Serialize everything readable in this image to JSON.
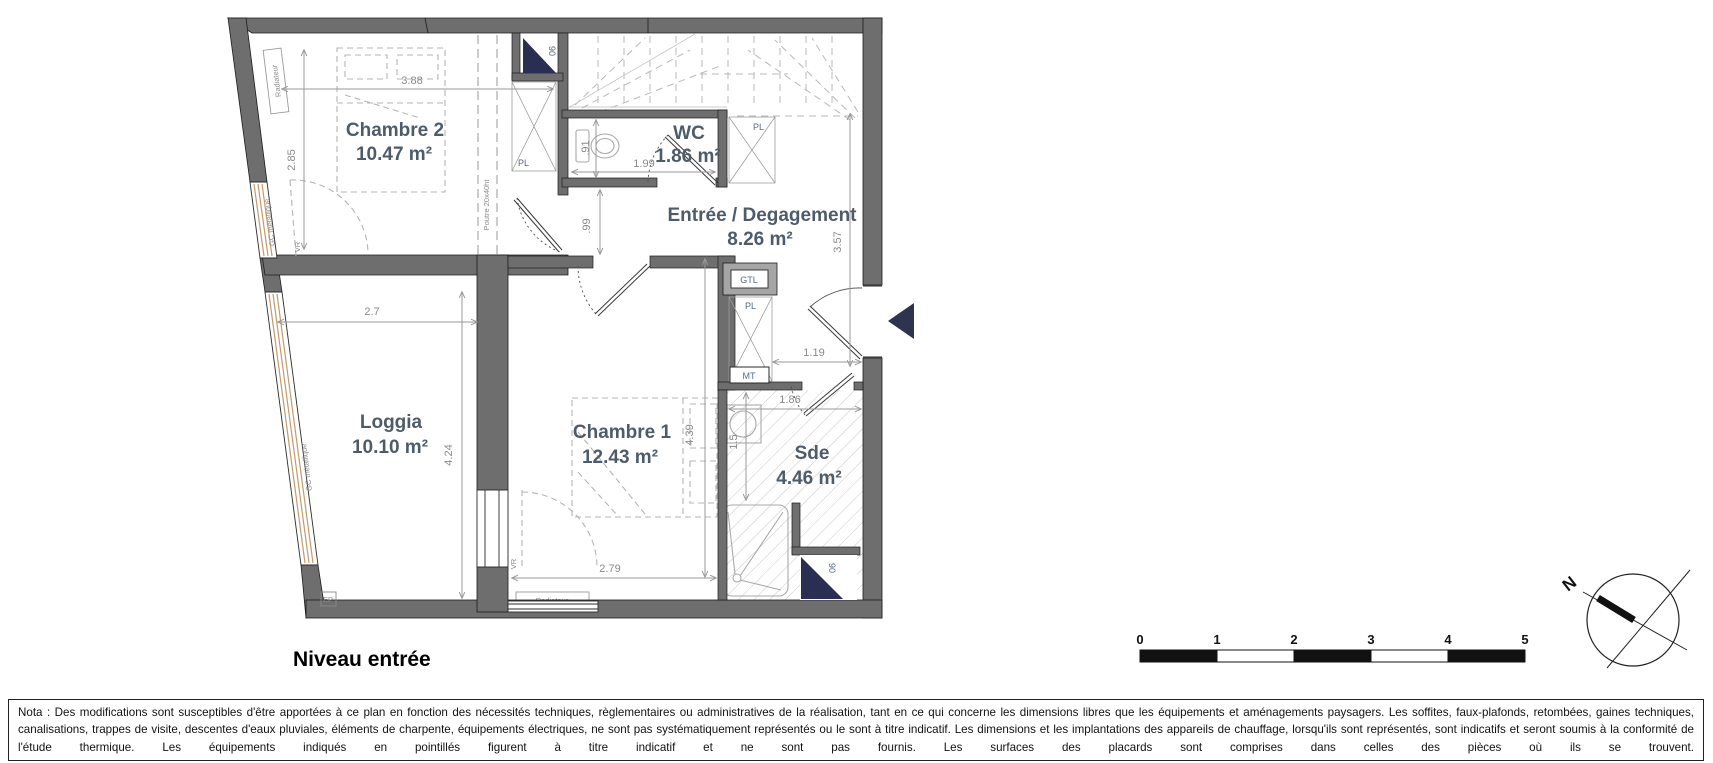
{
  "title": "Niveau entrée",
  "rooms": {
    "chambre2": {
      "name": "Chambre 2",
      "area": "10.47 m²"
    },
    "wc": {
      "name": "WC",
      "area": "1.86 m²"
    },
    "entree": {
      "name": "Entrée / Degagement",
      "area": "8.26 m²"
    },
    "loggia": {
      "name": "Loggia",
      "area": "10.10 m²"
    },
    "chambre1": {
      "name": "Chambre 1",
      "area": "12.43 m²"
    },
    "sde": {
      "name": "Sde",
      "area": "4.46 m²"
    }
  },
  "dimensions": {
    "chambre2_width": "3.88",
    "chambre2_height": "2.85",
    "wc_width": "1.99",
    "wc_height": ".91",
    "hall_width": ".99",
    "entree_height": "3.57",
    "entree_width": "1.19",
    "loggia_width": "2.7",
    "loggia_height": "4.24",
    "chambre1_width": "2.79",
    "chambre1_height": "4.39",
    "sde_width": "1.86",
    "sde_height": "1.5"
  },
  "labels": {
    "pl": "PL",
    "gtl": "GTL",
    "mt": "MT",
    "vr": "VR",
    "ep": "EP",
    "radiateur": "Radiateur",
    "gc_metallique": "GC métallique",
    "poutre": "Poutre 20x40ht",
    "tremie": "90"
  },
  "scale_bar": {
    "ticks": [
      "0",
      "1",
      "2",
      "3",
      "4",
      "5"
    ]
  },
  "compass": {
    "north": "N"
  },
  "nota": "Nota : Des modifications sont susceptibles d'être apportées à ce plan en fonction des nécessités techniques, règlementaires ou administratives de la réalisation, tant en ce qui concerne les dimensions libres que les équipements et aménagements paysagers. Les soffites, faux-plafonds, retombées, gaines techniques, canalisations, trappes de visite, descentes d'eaux pluviales, éléments de charpente, équipements électriques, ne sont pas systématiquement représentés ou le sont à titre indicatif. Les dimensions et les implantations des appareils de chauffage, lorsqu'ils sont représentés, sont indicatifs et seront soumis à la conformité de l'étude thermique. Les équipements indiqués en pointillés figurent à titre indicatif et ne sont pas fournis. Les surfaces des placards sont comprises dans celles des pièces où ils se trouvent.",
  "colors": {
    "wall": "#6e6e6e",
    "room_label": "#4e5c6a",
    "dim_text": "#8a8a8a",
    "stair_triangle": "#2a2e52",
    "window_stripe": "#c49a6c",
    "hatch": "#c6c6c6"
  }
}
